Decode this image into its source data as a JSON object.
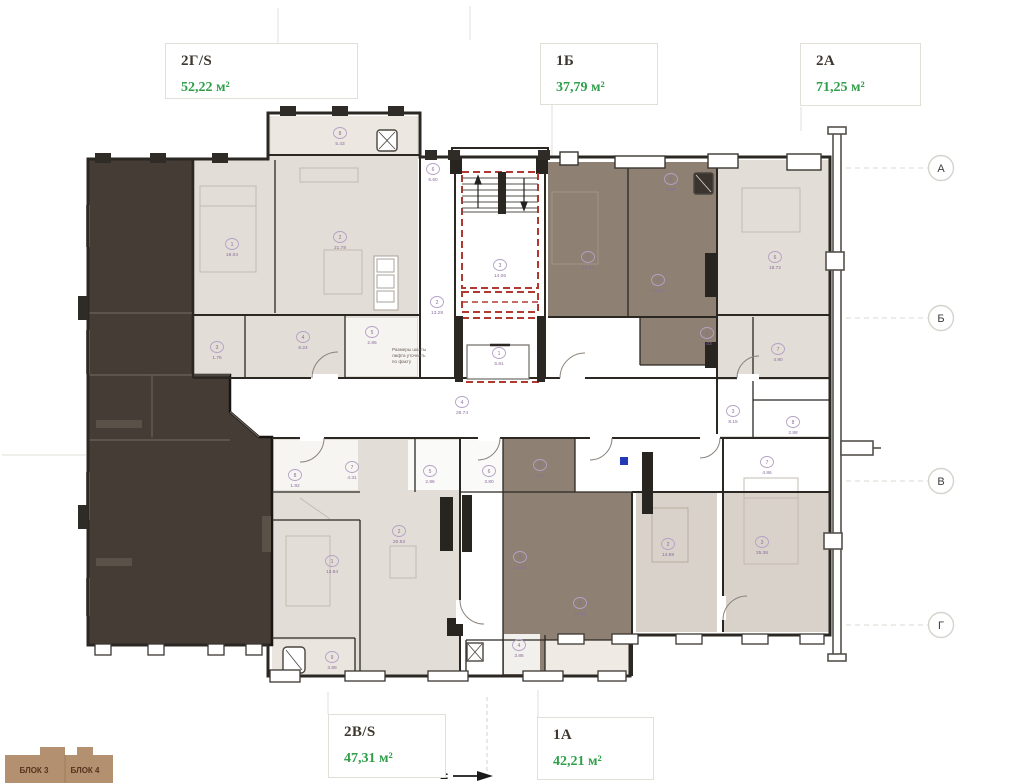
{
  "units": [
    {
      "code": "2Г/S",
      "area": "52,22 м²"
    },
    {
      "code": "1Б",
      "area": "37,79 м²"
    },
    {
      "code": "2А",
      "area": "71,25 м²"
    },
    {
      "code": "2В/S",
      "area": "47,31 м²"
    },
    {
      "code": "1А",
      "area": "42,21 м²"
    }
  ],
  "grid_axes": [
    {
      "label": "А",
      "y": 168
    },
    {
      "label": "Б",
      "y": 318
    },
    {
      "label": "В",
      "y": 481
    },
    {
      "label": "Г",
      "y": 625
    }
  ],
  "key_plan": {
    "labels": [
      "БЛОК 3",
      "БЛОК 4"
    ]
  },
  "note_lines": [
    "Размеры шахты",
    "лифта уточнять",
    "по факту"
  ],
  "section_marker": "=",
  "rooms": [
    {
      "x": 232,
      "y": 247,
      "n": "1",
      "a": "19.04"
    },
    {
      "x": 340,
      "y": 240,
      "n": "2",
      "a": "21.78"
    },
    {
      "x": 340,
      "y": 136,
      "n": "8",
      "a": "5.43"
    },
    {
      "x": 217,
      "y": 350,
      "n": "3",
      "a": "1.76"
    },
    {
      "x": 303,
      "y": 340,
      "n": "4",
      "a": "8.24"
    },
    {
      "x": 372,
      "y": 335,
      "n": "5",
      "a": "2.86"
    },
    {
      "x": 433,
      "y": 172,
      "n": "6",
      "a": "6.60"
    },
    {
      "x": 500,
      "y": 268,
      "n": "3",
      "a": "14.06"
    },
    {
      "x": 437,
      "y": 305,
      "n": "2",
      "a": "13.28"
    },
    {
      "x": 499,
      "y": 356,
      "n": "1",
      "a": "5.81"
    },
    {
      "x": 462,
      "y": 405,
      "n": "4",
      "a": "28.74"
    },
    {
      "x": 588,
      "y": 260,
      "n": "1",
      "a": "13.04"
    },
    {
      "x": 658,
      "y": 283,
      "n": "2",
      "a": "14.48"
    },
    {
      "x": 671,
      "y": 182,
      "n": "5",
      "a": "2.82"
    },
    {
      "x": 707,
      "y": 336,
      "n": "6",
      "a": "2.03"
    },
    {
      "x": 775,
      "y": 260,
      "n": "6",
      "a": "18.72"
    },
    {
      "x": 778,
      "y": 352,
      "n": "7",
      "a": "4.90"
    },
    {
      "x": 733,
      "y": 414,
      "n": "3",
      "a": "8.15"
    },
    {
      "x": 793,
      "y": 425,
      "n": "8",
      "a": "2.88"
    },
    {
      "x": 295,
      "y": 478,
      "n": "8",
      "a": "1.92"
    },
    {
      "x": 352,
      "y": 470,
      "n": "7",
      "a": "4.31"
    },
    {
      "x": 332,
      "y": 564,
      "n": "1",
      "a": "13.94"
    },
    {
      "x": 399,
      "y": 534,
      "n": "2",
      "a": "20.53"
    },
    {
      "x": 332,
      "y": 660,
      "n": "9",
      "a": "3.89"
    },
    {
      "x": 430,
      "y": 474,
      "n": "5",
      "a": "2.86"
    },
    {
      "x": 489,
      "y": 474,
      "n": "6",
      "a": "3.80"
    },
    {
      "x": 540,
      "y": 468,
      "n": "1",
      "a": "6.27"
    },
    {
      "x": 520,
      "y": 560,
      "n": "2",
      "a": "13.82"
    },
    {
      "x": 580,
      "y": 606,
      "n": "3",
      "a": "15.11"
    },
    {
      "x": 519,
      "y": 648,
      "n": "4",
      "a": "3.86"
    },
    {
      "x": 668,
      "y": 547,
      "n": "2",
      "a": "14.69"
    },
    {
      "x": 762,
      "y": 545,
      "n": "3",
      "a": "25.36"
    },
    {
      "x": 767,
      "y": 465,
      "n": "7",
      "a": "4.86"
    }
  ],
  "colors": {
    "highlight_unit": "#453c36",
    "room_taupe": "#8e8174",
    "room_beige": "#e2ddd6",
    "room_beige_dark": "#d8d2ca",
    "core_red": "#b03a32",
    "area_green": "#2f9e49",
    "label_purple": "#8a6d9c",
    "keyplan_tan": "#b3906f",
    "wall": "#2b2823"
  }
}
